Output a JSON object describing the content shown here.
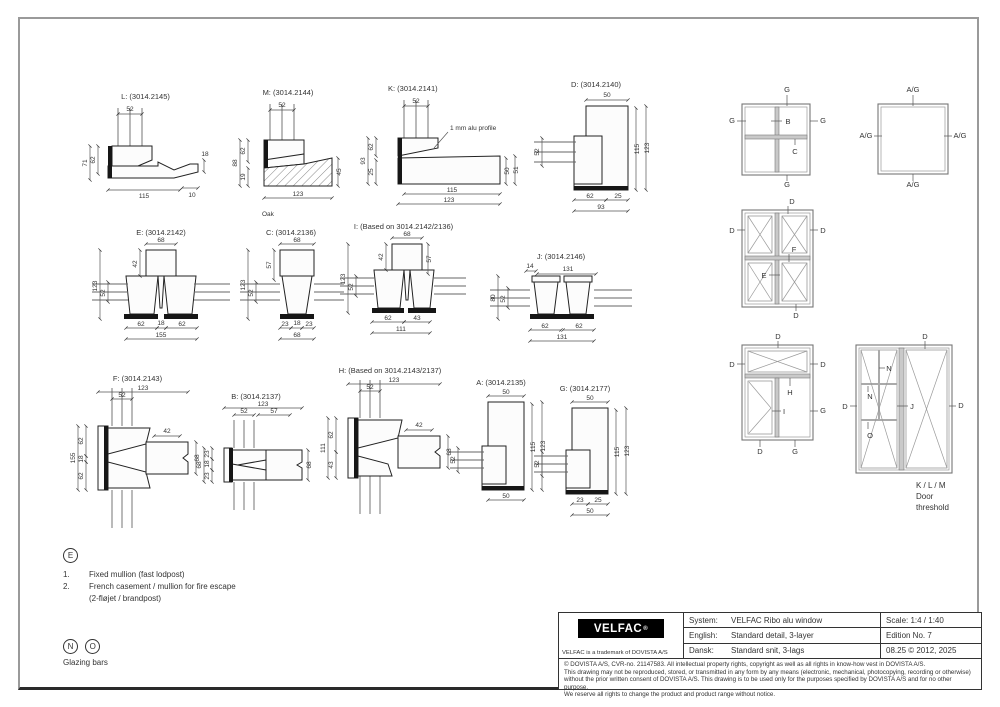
{
  "sections": {
    "L": {
      "title": "L: (3014.2145)",
      "d_top": "52",
      "d_h1": "71",
      "d_h2": "62",
      "d_r": "18",
      "d_b1": "115",
      "d_b2": "10"
    },
    "M": {
      "title": "M: (3014.2144)",
      "d_top": "52",
      "d_h1": "88",
      "d_h2": "62",
      "d_h3": "19",
      "d_r": "45",
      "d_b1": "123",
      "note": "Oak"
    },
    "K": {
      "title": "K: (3014.2141)",
      "d_top": "52",
      "d_h1": "93",
      "d_h2": "62",
      "d_h3": "25",
      "d_r1": "50",
      "d_r2": "51",
      "d_b1": "115",
      "d_b2": "123",
      "note": "1 mm alu profile"
    },
    "D": {
      "title": "D: (3014.2140)",
      "d_top": "50",
      "d_l": "52",
      "d_r1": "115",
      "d_r2": "123",
      "d_b1": "62",
      "d_b2": "25",
      "d_b3": "93"
    },
    "E": {
      "title": "E: (3014.2142)",
      "d_top": "68",
      "d_in": "42",
      "d_l1": "123",
      "d_l2": "52",
      "d_b1": "62",
      "d_b2": "18",
      "d_b3": "62",
      "d_b4": "155"
    },
    "C": {
      "title": "C: (3014.2136)",
      "d_top": "68",
      "d_in": "57",
      "d_l1": "123",
      "d_l2": "52",
      "d_b1": "23",
      "d_b2": "18",
      "d_b3": "23",
      "d_b4": "68"
    },
    "I": {
      "title": "I: (Based on 3014.2142/2136)",
      "d_top": "68",
      "d_in1": "42",
      "d_in2": "57",
      "d_l1": "123",
      "d_l2": "52",
      "d_b1": "62",
      "d_b2": "43",
      "d_b3": "111"
    },
    "J": {
      "title": "J: (3014.2146)",
      "d_t1": "14",
      "d_t2": "131",
      "d_l1": "80",
      "d_l2": "52",
      "d_b1": "62",
      "d_b2": "62",
      "d_b3": "131"
    },
    "F": {
      "title": "F: (3014.2143)",
      "d_t1": "123",
      "d_t2": "52",
      "d_l1": "155",
      "d_l2": "62",
      "d_l3": "18",
      "d_l4": "62",
      "d_in": "42",
      "d_r": "68"
    },
    "B": {
      "title": "B: (3014.2137)",
      "d_t1": "123",
      "d_t2": "52",
      "d_t3": "57",
      "d_l1": "68",
      "d_l2": "23",
      "d_l3": "18",
      "d_l4": "23",
      "d_r": "68"
    },
    "H": {
      "title": "H: (Based on 3014.2143/2137)",
      "d_t1": "123",
      "d_t2": "52",
      "d_l1": "111",
      "d_l2": "62",
      "d_l3": "43",
      "d_in": "42",
      "d_r": "68"
    },
    "A": {
      "title": "A: (3014.2135)",
      "d_top": "50",
      "d_l": "52",
      "d_r1": "115",
      "d_r2": "123",
      "d_b": "50"
    },
    "G": {
      "title": "G: (3014.2177)",
      "d_top": "50",
      "d_l": "52",
      "d_r1": "115",
      "d_r2": "123",
      "d_b1": "23",
      "d_b2": "25",
      "d_b3": "50"
    }
  },
  "elevations": {
    "r1": {
      "top": "G",
      "left": "G",
      "center": "B",
      "right": "G",
      "lower": "C",
      "bottom": "G"
    },
    "r2": {
      "top": "A/G",
      "left": "A/G",
      "right": "A/G",
      "bottom": "A/G"
    },
    "r3": {
      "top": "D",
      "left": "D",
      "right": "D",
      "transom": "F",
      "mullion": "E",
      "bottom": "D"
    },
    "r4": {
      "top": "D",
      "left": "D",
      "right": "D",
      "transom": "H",
      "mullion": "I",
      "right_mid": "G",
      "bottom_left": "D",
      "bottom_right": "G"
    },
    "r5": {
      "top": "D",
      "left": "D",
      "right": "D",
      "bar1": "N",
      "bar2": "N",
      "bar3": "O",
      "meeting": "J",
      "caption1": "K / L / M",
      "caption2": "Door",
      "caption3": "threshold"
    }
  },
  "notes": {
    "e_badge": "E",
    "item1_no": "1.",
    "item1": "Fixed mullion (fast lodpost)",
    "item2_no": "2.",
    "item2": "French casement / mullion for fire escape",
    "item2b": "(2-fløjet / brandpost)",
    "n_badge": "N",
    "o_badge": "O",
    "glazing": "Glazing bars"
  },
  "titleblock": {
    "logo": "VELFAC",
    "logo_r": "®",
    "trademark": "VELFAC is a trademark of DOVISTA A/S",
    "rows": [
      {
        "label": "System:",
        "value": "VELFAC Ribo alu window"
      },
      {
        "label": "English:",
        "value": "Standard detail, 3-layer"
      },
      {
        "label": "Dansk:",
        "value": "Standard snit, 3-lags"
      }
    ],
    "scale": "Scale: 1:4 / 1:40",
    "edition": "Edition No. 7",
    "date": "08.25 © 2012, 2025",
    "copy1": "© DOVISTA A/S, CVR-no. 21147583. All intellectual property rights, copyright as well as all rights in know-how vest in DOVISTA A/S.",
    "copy2": "This drawing may not be reproduced, stored, or transmitted in any form by any means (electronic, mechanical, photocopying, recording or otherwise)",
    "copy3": "without the prior written consent of DOVISTA A/S. This drawing is to be used only for the purposes specified by DOVISTA A/S and for no other purpose.",
    "copy4": "We reserve all rights to change the product and product range without notice."
  }
}
